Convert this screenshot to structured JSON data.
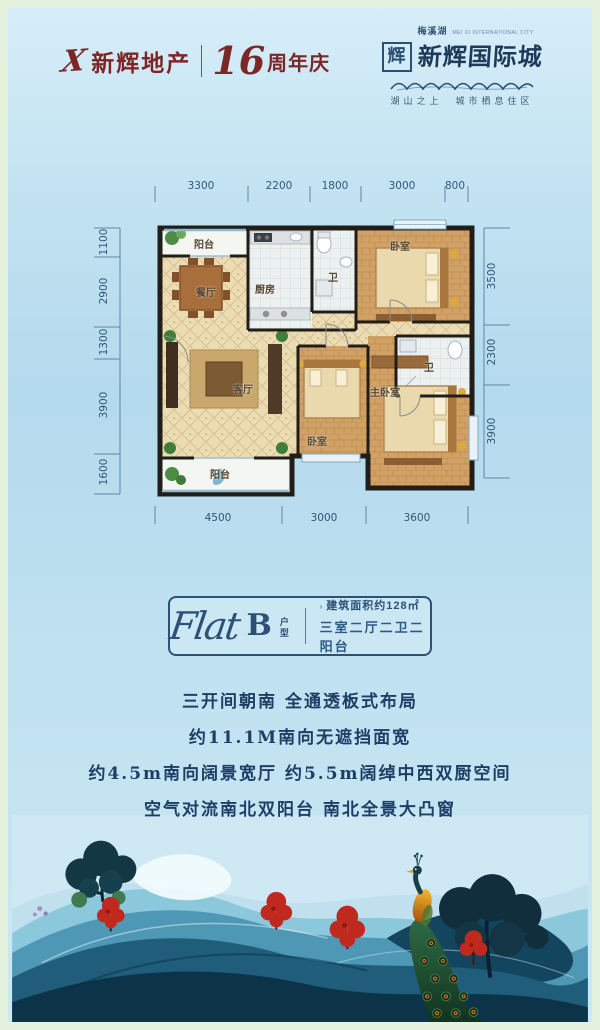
{
  "colors": {
    "brand_red": "#7d2626",
    "navy_text": "#1d3f66",
    "badge_border": "#2d5174",
    "dim_text": "#2f5878",
    "frame_green": "#e4f2de",
    "sky_blue": "#bfe1f0"
  },
  "header": {
    "brand": {
      "mark": "X",
      "name": "新辉地产",
      "anniversary_number": "16",
      "anniversary_text": "周年庆"
    },
    "logo": {
      "seal": "辉",
      "district": "梅溪湖",
      "district_en": "MEI XI INTERNATIONAL CITY",
      "name": "新辉国际城",
      "tagline": "湖山之上　城市栖息住区"
    }
  },
  "floorplan": {
    "dims_top": [
      "3300",
      "2200",
      "1800",
      "3000",
      "800"
    ],
    "dims_left": [
      "1100",
      "2900",
      "1300",
      "3900",
      "1600"
    ],
    "dims_right": [
      "3500",
      "2300",
      "3900"
    ],
    "dims_bottom": [
      "4500",
      "3000",
      "3600"
    ],
    "rooms": {
      "balcony_top": "阳台",
      "dining": "餐厅",
      "kitchen": "厨房",
      "bath1": "卫",
      "bedroom_ne": "卧室",
      "living": "客厅",
      "bedroom_s": "卧室",
      "master": "主卧室",
      "bath2": "卫",
      "balcony_bottom": "阳台"
    }
  },
  "badge": {
    "script": "Flat",
    "letter": "B",
    "letter_suffix": "户型",
    "marker": "›",
    "area": "建筑面积约128㎡",
    "rooms": "三室二厅二卫二阳台"
  },
  "features": [
    "三开间朝南 全通透板式布局",
    "约11.1M南向无遮挡面宽",
    "约4.5m南向阔景宽厅 约5.5m阔绰中西双厨空间",
    "空气对流南北双阳台 南北全景大凸窗"
  ]
}
